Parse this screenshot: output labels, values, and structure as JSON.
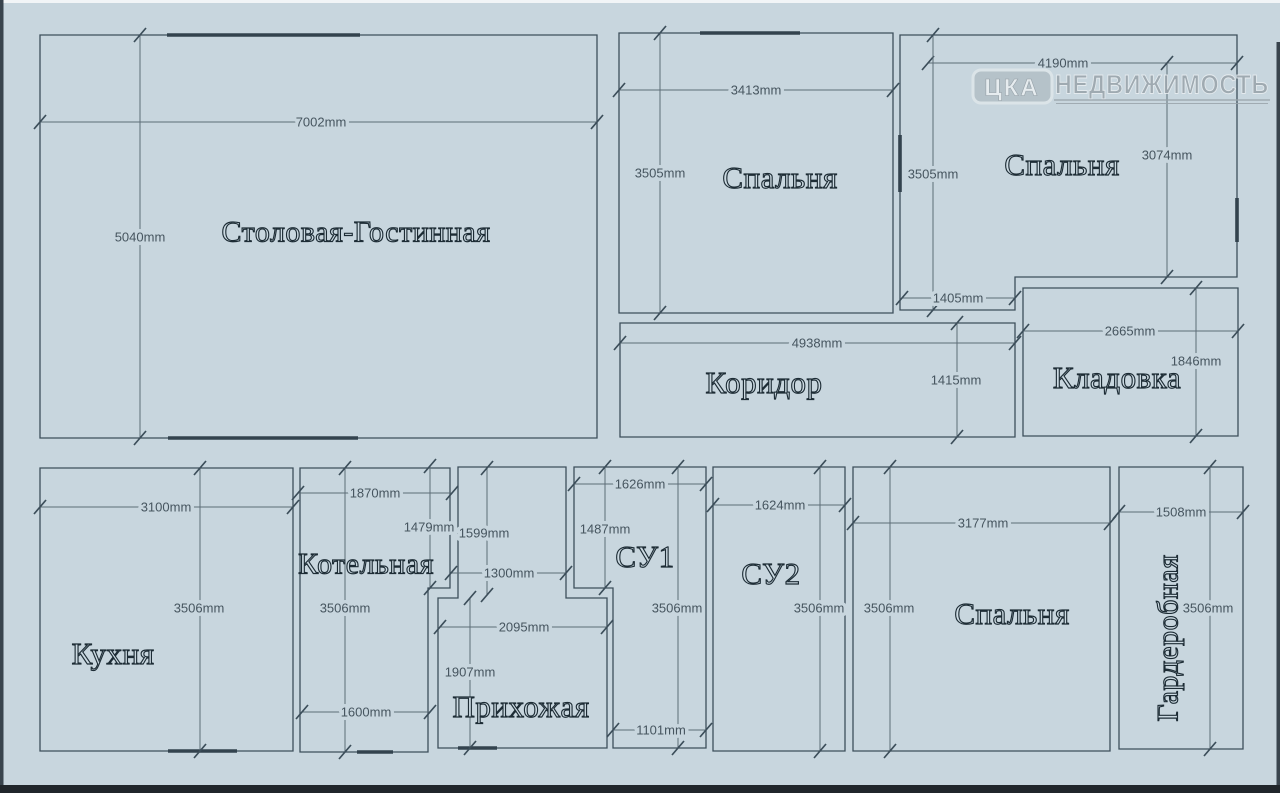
{
  "colors": {
    "background": "#c8d6de",
    "wall": "#3d4f5b",
    "dim_text": "#46555f"
  },
  "logo": {
    "badge": "ЦКА",
    "name": "НЕДВИЖИМОСТЬ"
  },
  "rooms": {
    "living": {
      "label": "Столовая-Гостинная",
      "width": "7002mm",
      "height": "5040mm"
    },
    "bedroom_top_middle": {
      "label": "Спальня",
      "width": "3413mm",
      "height": "3505mm"
    },
    "bedroom_top_right": {
      "label": "Спальня",
      "width": "4190mm",
      "height_left": "3505mm",
      "height_right": "3074mm",
      "bottom_inset": "1405mm"
    },
    "corridor": {
      "label": "Коридор",
      "width": "4938mm",
      "height": "1415mm"
    },
    "storage": {
      "label": "Кладовка",
      "width": "2665mm",
      "height": "1846mm"
    },
    "kitchen": {
      "label": "Кухня",
      "width": "3100mm",
      "height": "3506mm"
    },
    "boiler": {
      "label": "Котельная",
      "top_width": "1870mm",
      "upper_right_height": "1479mm",
      "height": "3506mm",
      "bottom_width": "1600mm"
    },
    "hallway": {
      "label": "Прихожая",
      "upper_height": "1599mm",
      "upper_width": "1300mm",
      "lower_width": "2095mm",
      "lower_height": "1907mm"
    },
    "su1": {
      "label": "СУ1",
      "top_width": "1626mm",
      "upper_left_height": "1487mm",
      "height": "3506mm",
      "bottom_width": "1101mm"
    },
    "su2": {
      "label": "СУ2",
      "width": "1624mm",
      "height": "3506mm"
    },
    "bedroom_bottom": {
      "label": "Спальня",
      "width": "3177mm",
      "height": "3506mm"
    },
    "wardrobe": {
      "label": "Гардеробная",
      "width": "1508mm",
      "height": "3506mm"
    }
  }
}
